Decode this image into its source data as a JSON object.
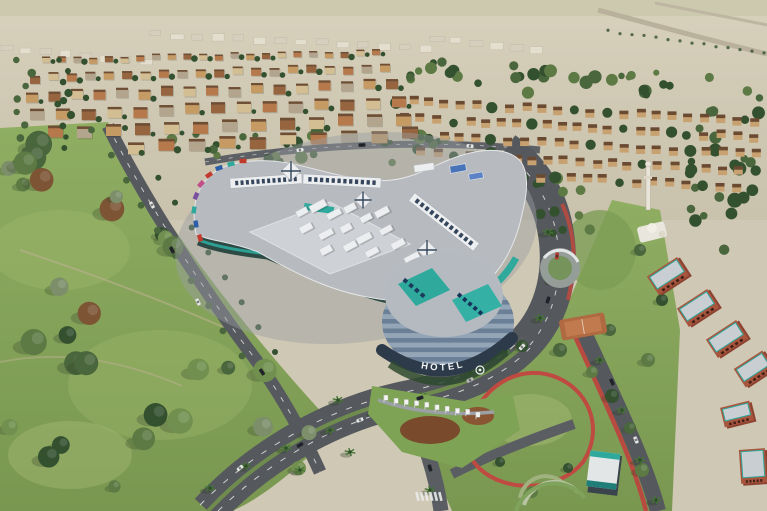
{
  "scene": {
    "hotel_sign": "HOTEL",
    "flags_count": 10,
    "hotel_floor_bands": 8,
    "palette": {
      "desert_top": "#d8d1bc",
      "desert_bottom": "#c9c2ac",
      "horizon_tint": "#c7c6aa",
      "distant_block": "#e4decf",
      "distant_block_alt": "#d7cfbe",
      "block_cream": "#d3bd92",
      "block_tan": "#c59a63",
      "block_terracotta": "#b5794c",
      "block_brown": "#96653f",
      "block_gray": "#b3a58d",
      "block_roof": "#6e4f36",
      "villa_wall": "#c8a171",
      "villa_roof": "#6b4a32",
      "tree_dark": "#33502f",
      "tree_mid": "#49663c",
      "tree_olive": "#5d7a45",
      "tree_light": "#71904f",
      "tree_sage": "#7c8f6a",
      "tree_rust": "#7d5535",
      "grass_light": "#97b06a",
      "grass": "#84a058",
      "grass_dark": "#6d8a47",
      "lawn_pale": "#a3b873",
      "road": "#56595e",
      "road_dark": "#45484d",
      "lane_white": "#e8e8e6",
      "path_tan": "#b9b08e",
      "track_red": "#b84a40",
      "roof_gray": "#b7babf",
      "roof_light": "#ced1d5",
      "roof_white": "#eceeef",
      "skylight_frame": "#35465c",
      "canopy_blue": "#4a74b8",
      "teal": "#2ea99c",
      "teal_dark": "#1f7f78",
      "fascia_glass": "#2e4a44",
      "hotel_face": "#93a5b6",
      "hotel_band": "#6b8097",
      "drum_roof": "#b4bac0",
      "canopy_dark": "#2c3a49",
      "sign_text": "#f0f3f5",
      "brick": "#a8553e",
      "brick_dark": "#8c4331",
      "block_roof_gray": "#c9ced2",
      "clay": "#b06a42",
      "white_structure": "#e9e6dd",
      "car_light": "#e6e6e4",
      "car_dark": "#22252b",
      "car_red": "#b03a30",
      "flag_white": "#f2f3f2"
    }
  }
}
